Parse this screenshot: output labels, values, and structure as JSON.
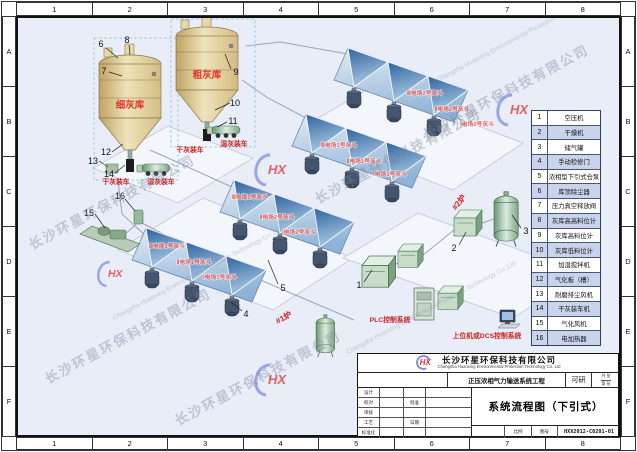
{
  "frame": {
    "cols": [
      "1",
      "2",
      "3",
      "4",
      "5",
      "6",
      "7",
      "8"
    ],
    "rows": [
      "A",
      "B",
      "C",
      "D",
      "E",
      "F"
    ]
  },
  "legend": {
    "items": [
      {
        "num": "1",
        "label": "空压机"
      },
      {
        "num": "2",
        "label": "干燥机"
      },
      {
        "num": "3",
        "label": "储气罐"
      },
      {
        "num": "4",
        "label": "手动检修门"
      },
      {
        "num": "5",
        "label": "浓相型下引式仓泵"
      },
      {
        "num": "6",
        "label": "库顶除尘器"
      },
      {
        "num": "7",
        "label": "压力真空释放阀"
      },
      {
        "num": "8",
        "label": "灰库高高料位计"
      },
      {
        "num": "9",
        "label": "灰库高料位计"
      },
      {
        "num": "10",
        "label": "灰库低料位计"
      },
      {
        "num": "11",
        "label": "加湿搅拌机"
      },
      {
        "num": "12",
        "label": "气化板（槽）"
      },
      {
        "num": "13",
        "label": "耐磨排尘风机"
      },
      {
        "num": "14",
        "label": "干灰装车机"
      },
      {
        "num": "15",
        "label": "气化风机"
      },
      {
        "num": "16",
        "label": "电加热器"
      }
    ]
  },
  "hoppers": {
    "back": [
      "Ⅲ电场2号灰斗",
      "Ⅱ电场2号灰斗",
      "Ⅰ电场2号灰斗"
    ],
    "front": [
      "Ⅲ电场1号灰斗",
      "Ⅱ电场1号灰斗",
      "Ⅰ电场1号灰斗"
    ]
  },
  "equip": {
    "silo_fine": "细灰库",
    "silo_coarse": "粗灰库",
    "dry_truck": "干灰装车",
    "wet_truck": "湿灰装车",
    "boiler1": "#1炉",
    "boiler2": "#2炉",
    "plc": "PLC控制系统",
    "dcs": "上位机或DCS控制系统"
  },
  "callouts": [
    "1",
    "2",
    "3",
    "4",
    "5",
    "6",
    "7",
    "8",
    "9",
    "10",
    "11",
    "12",
    "13",
    "14",
    "15",
    "16"
  ],
  "titleblock": {
    "company_cn": "长沙环星环保科技有限公司",
    "company_en": "Changsha Huanxing Environmental Protection Technology Co.,Ltd",
    "project": "正压浓相气力输送系统工程",
    "stage": "可研",
    "sheets_total": "共 张",
    "sheet_no": "第 张",
    "title": "系统流程图（下引式）",
    "drawing_no": "HXX2012-C0201-01",
    "fields": {
      "design": "设计",
      "check": "校对",
      "review": "审核",
      "process": "工艺",
      "standard": "标准化",
      "approve": "批准",
      "date": "日期",
      "scale": "比例",
      "dwg": "图号"
    }
  },
  "watermark": {
    "cn": "长沙环星环保科技有限公司",
    "en": "Changsha Huanxing Environmental Protection Technology Co.,Ltd",
    "logo": "HX"
  }
}
